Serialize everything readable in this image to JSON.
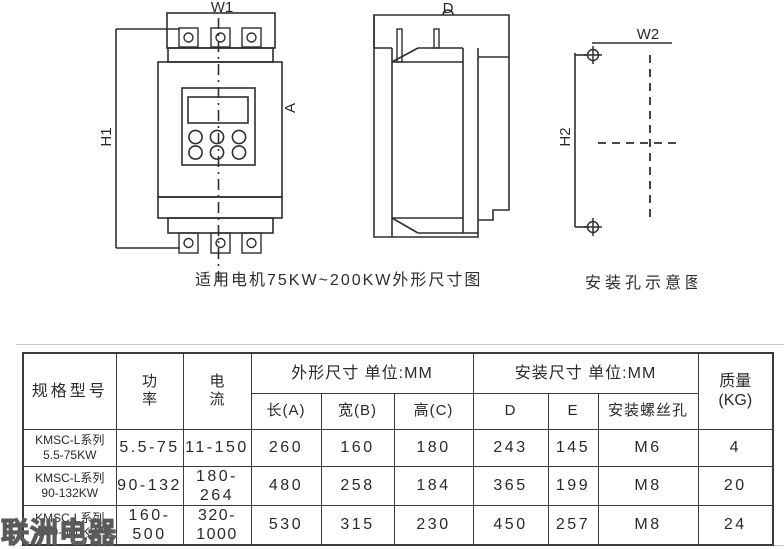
{
  "drawings": {
    "front_view": {
      "labels": {
        "w1": "W1",
        "h1": "H1",
        "a": "A"
      },
      "caption": "适用电机75KW~200KW外形尺寸图"
    },
    "side_view": {
      "labels": {
        "d": "D"
      }
    },
    "mounting_view": {
      "labels": {
        "w2": "W2",
        "h2": "H2"
      },
      "caption": "安装孔示意图"
    }
  },
  "table": {
    "headers": {
      "model": "规格型号",
      "power": "功\n率",
      "current": "电\n流",
      "dims_group": "外形尺寸 单位:MM",
      "mount_group": "安装尺寸 单位:MM",
      "length": "长(A)",
      "width": "宽(B)",
      "height": "高(C)",
      "d": "D",
      "e": "E",
      "screw": "安装螺丝孔",
      "weight": "质量\n(KG)"
    },
    "rows": [
      {
        "model": "KMSC-L系列\n5.5-75KW",
        "power": "5.5-75",
        "current": "11-150",
        "length": "260",
        "width": "160",
        "height": "180",
        "d": "243",
        "e": "145",
        "screw": "M6",
        "weight": "4"
      },
      {
        "model": "KMSC-L系列\n90-132KW",
        "power": "90-132",
        "current": "180-264",
        "length": "480",
        "width": "258",
        "height": "184",
        "d": "365",
        "e": "199",
        "screw": "M8",
        "weight": "20"
      },
      {
        "model": "KMSC-L系列\n160-500KW",
        "power": "160-500",
        "current": "320-\n1000",
        "length": "530",
        "width": "315",
        "height": "230",
        "d": "450",
        "e": "257",
        "screw": "M8",
        "weight": "24"
      }
    ]
  },
  "watermark": "联洲电器",
  "colors": {
    "line": "#2f2f2f",
    "table_border": "#3b3b3b",
    "text": "#2a2a2a"
  }
}
